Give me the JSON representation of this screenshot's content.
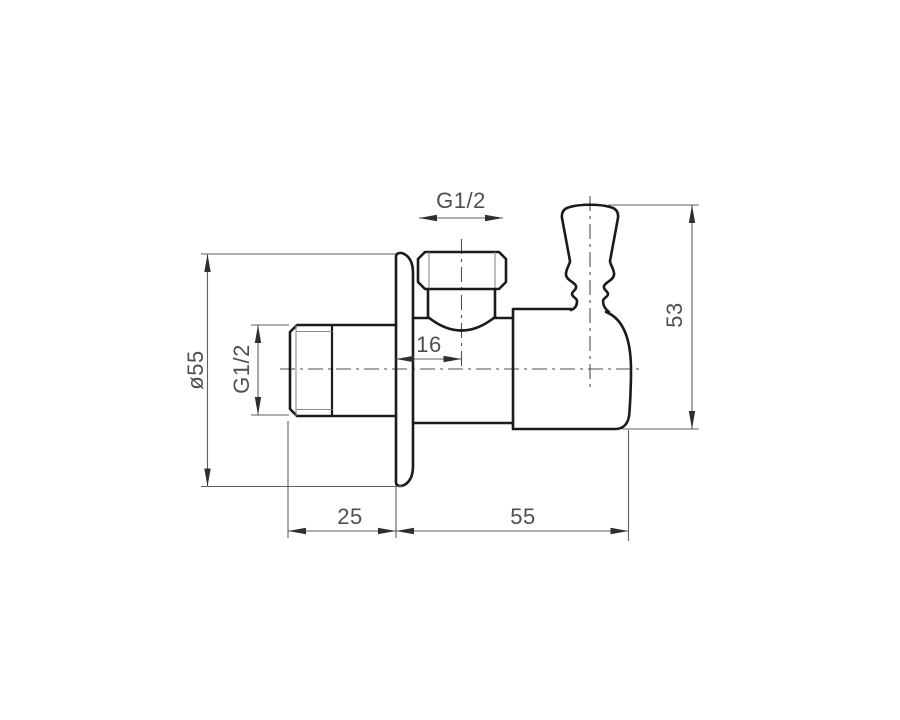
{
  "drawing": {
    "dimension_labels": {
      "outlet_thread": "G1/2",
      "outlet_offset": "16",
      "flange_diameter": "ø55",
      "inlet_thread": "G1/2",
      "overall_height": "53",
      "inlet_length": "25",
      "body_length": "55"
    },
    "colors": {
      "background": "#ffffff",
      "outline": "#1b1b1b",
      "thread_line": "#8a8a8a",
      "dim_line": "#606060",
      "centerline": "#4f4f4f",
      "arrow": "#2f2f2f",
      "text": "#4f4f4f"
    }
  }
}
